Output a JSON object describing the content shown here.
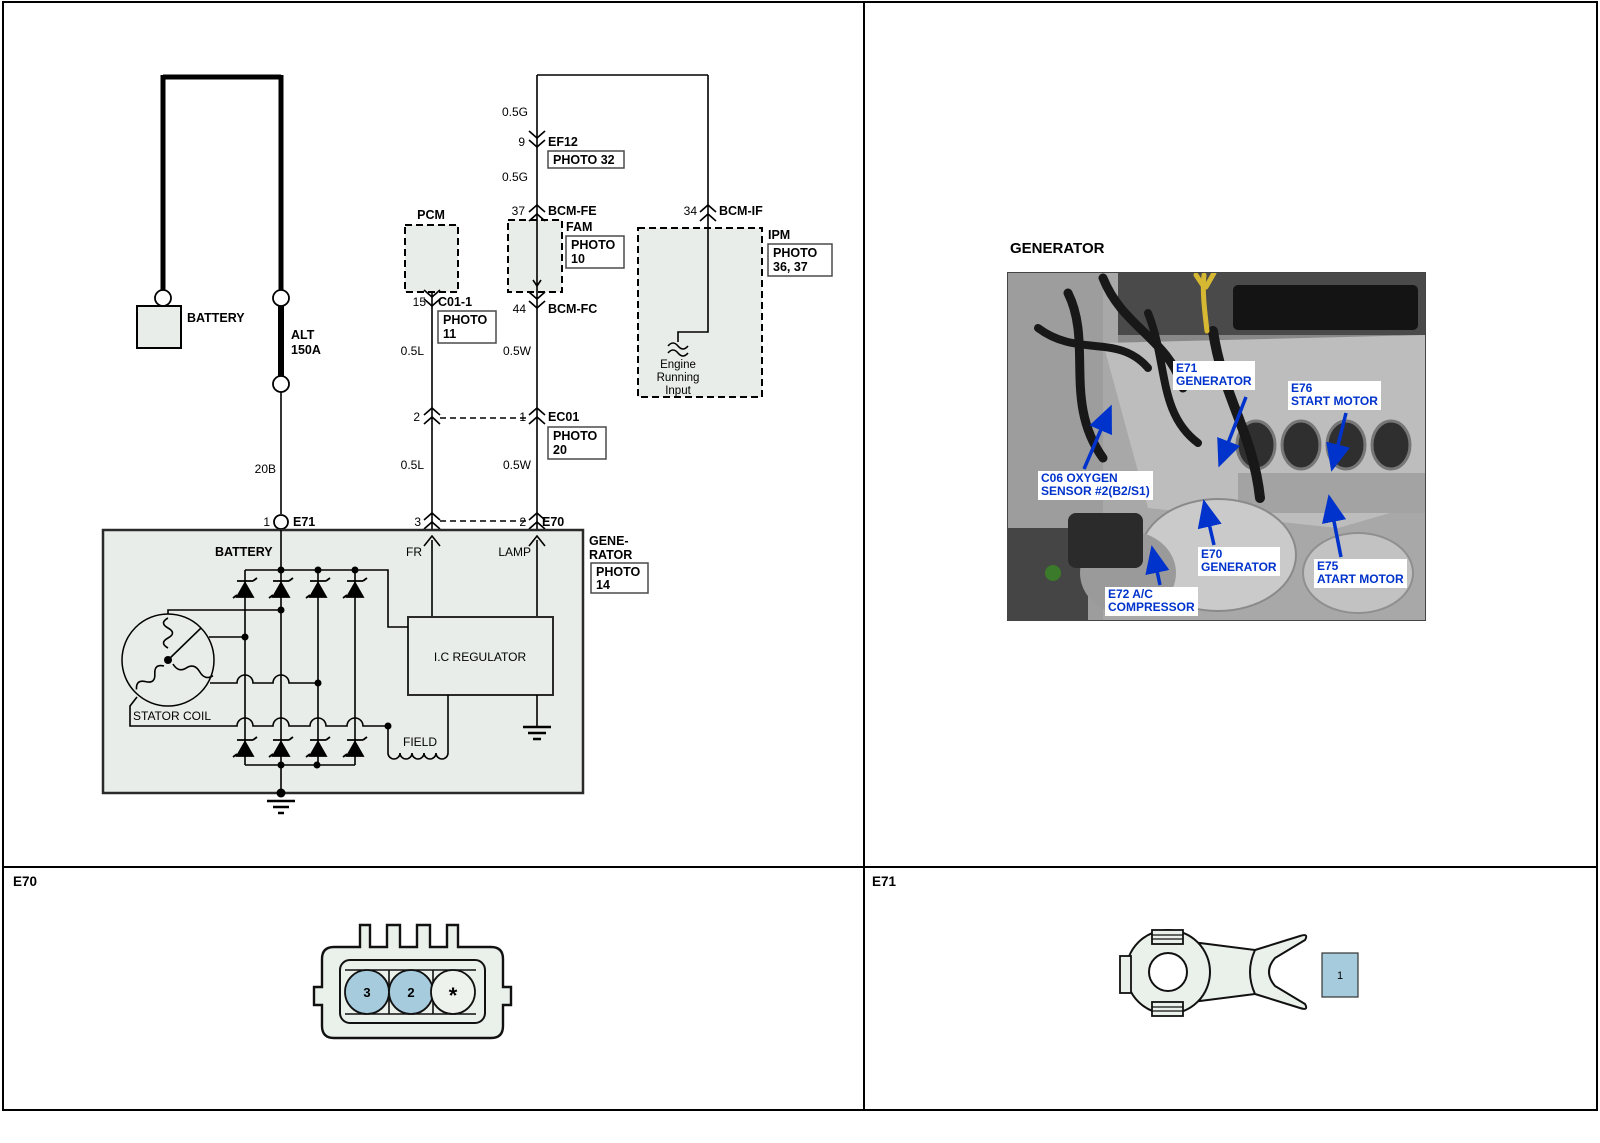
{
  "frame": {
    "e70_panel_label": "E70",
    "e71_panel_label": "E71"
  },
  "wiring": {
    "battery_label": "BATTERY",
    "fuse_name": "ALT",
    "fuse_rating": "150A",
    "fuse_wire": "20B",
    "wire_g_top": "0.5G",
    "wire_g_mid": "0.5G",
    "pin_9": "9",
    "conn_ef12": "EF12",
    "photo_32": "PHOTO 32",
    "pcm_label": "PCM",
    "pin_15": "15",
    "conn_c01_1": "C01-1",
    "photo_word": "PHOTO",
    "photo_11": "11",
    "pin_37": "37",
    "conn_bcm_fe": "BCM-FE",
    "fam_label": "FAM",
    "photo_10": "10",
    "pin_44": "44",
    "conn_bcm_fc": "BCM-FC",
    "pin_34": "34",
    "conn_bcm_if": "BCM-IF",
    "ipm_label": "IPM",
    "photo_36_37": "36, 37",
    "engine_running_1": "Engine",
    "engine_running_2": "Running",
    "engine_running_3": "Input",
    "wire_l_1": "0.5L",
    "wire_w_1": "0.5W",
    "pin_2a": "2",
    "pin_1a": "1",
    "conn_ec01": "EC01",
    "photo_20": "20",
    "wire_l_2": "0.5L",
    "wire_w_2": "0.5W",
    "pin_3": "3",
    "pin_2b": "2",
    "conn_e70": "E70",
    "pin_1b": "1",
    "conn_e71": "E71",
    "gen_label_1": "GENE-",
    "gen_label_2": "RATOR",
    "photo_14": "14",
    "gen_battery": "BATTERY",
    "gen_fr": "FR",
    "gen_lamp": "LAMP",
    "gen_regulator": "I.C REGULATOR",
    "gen_stator": "STATOR COIL",
    "gen_field": "FIELD"
  },
  "photo": {
    "title": "GENERATOR",
    "callouts": {
      "e71": {
        "l1": "E71",
        "l2": "GENERATOR"
      },
      "e76": {
        "l1": "E76",
        "l2": "START MOTOR"
      },
      "c06": {
        "l1": "C06 OXYGEN",
        "l2": "SENSOR #2(B2/S1)"
      },
      "e70": {
        "l1": "E70",
        "l2": "GENERATOR"
      },
      "e75": {
        "l1": "E75",
        "l2": "ATART MOTOR"
      },
      "e72": {
        "l1": "E72 A/C",
        "l2": "COMPRESSOR"
      }
    }
  },
  "connectors": {
    "e70_pin_3": "3",
    "e70_pin_2": "2",
    "e70_pin_star": "*",
    "e71_pin_1": "1"
  },
  "colors": {
    "callout_blue": "#0033cc",
    "pin_blue": "#a5cbdd",
    "box_fill": "#e9ede9"
  }
}
